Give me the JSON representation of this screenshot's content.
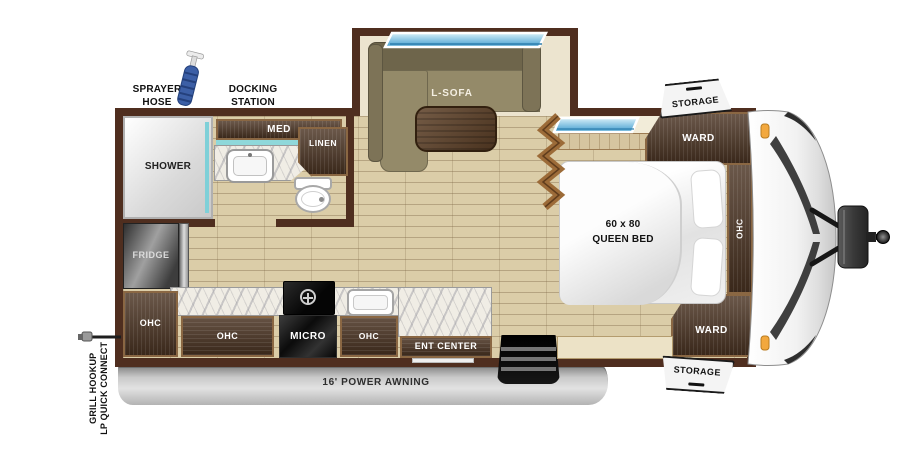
{
  "exterior": {
    "sprayer_hose": "SPRAYER\nHOSE",
    "docking_station": "DOCKING\nSTATION",
    "grill_hookup": "GRILL HOOKUP\nLP QUICK CONNECT",
    "storage_top": "STORAGE",
    "storage_bottom": "STORAGE",
    "awning": "16' POWER AWNING"
  },
  "bathroom": {
    "shower": "SHOWER",
    "med": "MED",
    "linen": "LINEN"
  },
  "living": {
    "sofa": "L-SOFA"
  },
  "kitchen": {
    "fridge": "FRIDGE",
    "ohc_wall": "OHC",
    "ohc_lower": "OHC",
    "ohc_right": "OHC",
    "micro": "MICRO",
    "ent_center": "ENT CENTER"
  },
  "bedroom": {
    "bed": "60 x 80\nQUEEN BED",
    "ward_front": "WARD",
    "ward_rear": "WARD",
    "ohc": "OHC"
  },
  "colors": {
    "wall": "#4f2e1f",
    "wood": "#4a3322",
    "wood_trim": "#8a6743",
    "floor": "#dbcda8",
    "slide_floor": "#ece4cf",
    "teal_accent": "#7fd0d8",
    "window_blue": "#58b0dc",
    "awning_gray": "#c4c4c4",
    "sofa_olive": "#938968",
    "marker_light_orange": "#f2a83e"
  }
}
